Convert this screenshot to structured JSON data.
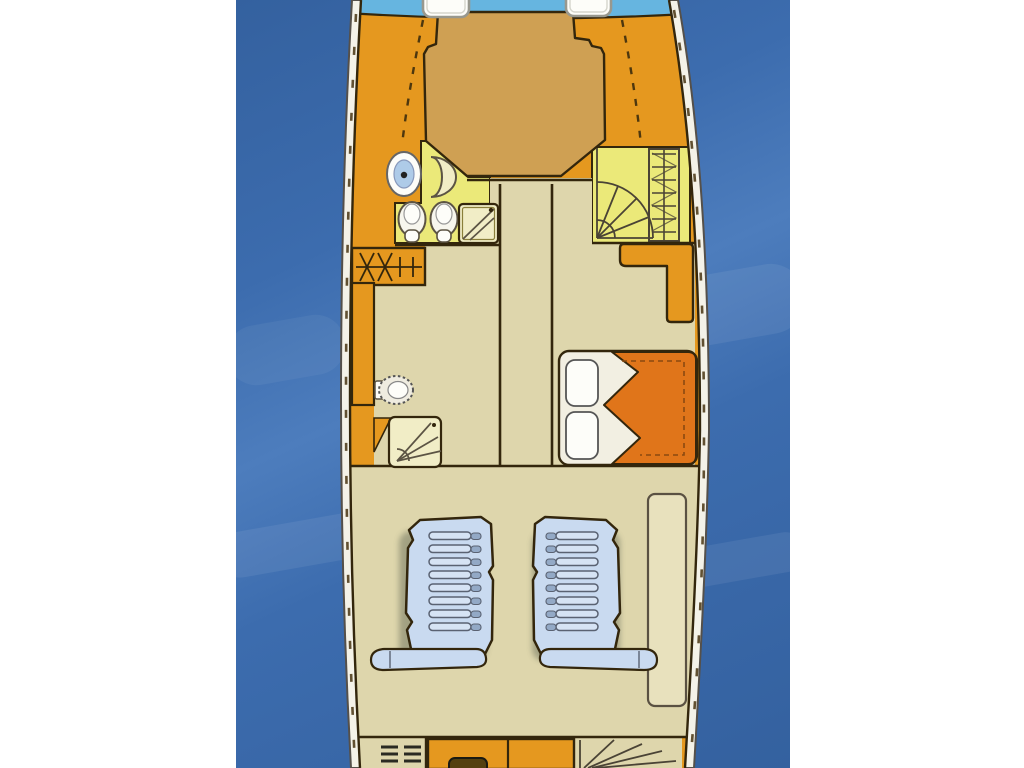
{
  "meta": {
    "description": "Top-down lower-deck floor plan of a motor yacht shown over open water; drawing contains no text labels",
    "visible_text": []
  },
  "colors": {
    "margin": "#ffffff",
    "water": "#3c6cae",
    "water_light": "#4d7dbd",
    "water_dark": "#34619f",
    "band": "#f4f2e8",
    "line": "#33260c",
    "orange": "#e5981f",
    "tan": "#cfa053",
    "yellow": "#ebe979",
    "beige": "#ded6ac",
    "pale": "#f1edc6",
    "white": "#fdfdf9",
    "deckblue": "#66b5e0",
    "seat": "#c9daf0",
    "rib": "#d6e3f4",
    "stub": "#93a9c6",
    "duvet": "#e0751a",
    "counter": "#e8e1bd",
    "sinkblue": "#aecbe8",
    "appliance": "#54400f",
    "hatch_stroke": "#98988e",
    "dash": "#473411"
  },
  "scene": {
    "background": "open water",
    "vessel": {
      "foredeck": {
        "hatch_count": 2
      },
      "bow_cabin": {
        "berth": "island double berth",
        "ensuite_fixtures": [
          "washbasin",
          "toilet",
          "bidet",
          "shower-pan",
          "corner-seat"
        ],
        "access": [
          "fan-staircase",
          "companionway-ladder"
        ]
      },
      "midship": {
        "port_cabin": [
          "wardrobe",
          "side-cabinet",
          "toilet",
          "shower"
        ],
        "corridor": "central passageway",
        "starboard_cabin": [
          "l-shaped-cabinet",
          "double-bed with two pillows and duvet"
        ]
      },
      "wheelhouse": {
        "helm_seat_count": 2,
        "side_counter": 1
      },
      "aft_galley": [
        "vent-louver",
        "counter",
        "sink",
        "companionway-stairs"
      ]
    }
  }
}
